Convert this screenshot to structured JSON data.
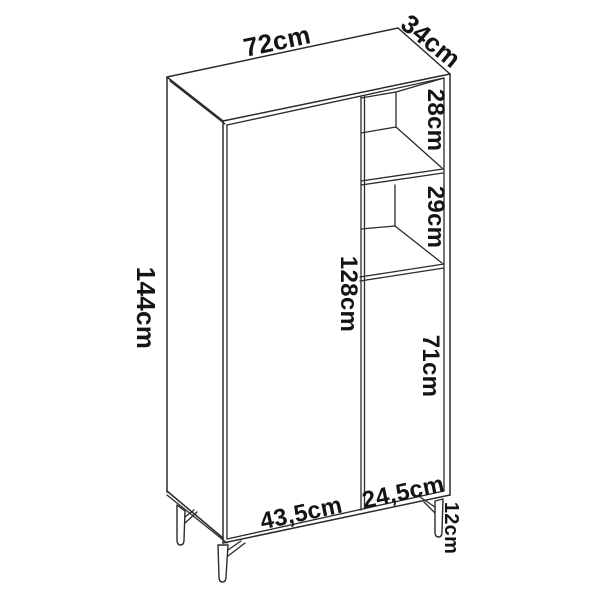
{
  "diagram": {
    "type": "furniture-dimension-line-drawing",
    "subject": "tall cabinet with two doors, open shelves and metal legs",
    "unit": "cm",
    "labels": {
      "top_width": "72cm",
      "top_depth": "34cm",
      "total_height": "144cm",
      "upper_shelf_height": "28cm",
      "middle_shelf_height": "29cm",
      "left_door_height": "128cm",
      "right_door_height": "71cm",
      "left_door_width": "43,5cm",
      "right_door_width": "24,5cm",
      "leg_height": "12cm"
    },
    "colors": {
      "line": "#2b2b2b",
      "text": "#141414",
      "background": "#ffffff"
    }
  }
}
